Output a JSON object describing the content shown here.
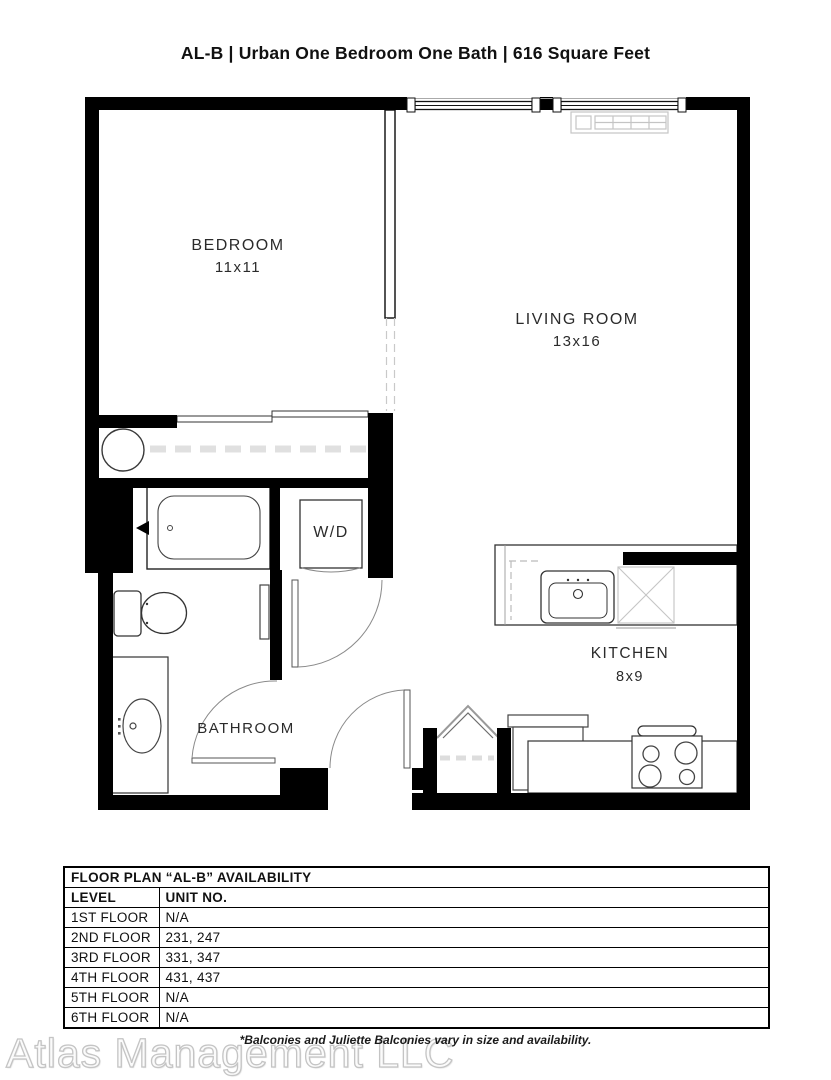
{
  "title": "AL-B | Urban One Bedroom One Bath | 616 Square Feet",
  "plan": {
    "rooms": {
      "bedroom": {
        "name": "BEDROOM",
        "dims": "11x11"
      },
      "living_room": {
        "name": "LIVING ROOM",
        "dims": "13x16"
      },
      "kitchen": {
        "name": "KITCHEN",
        "dims": "8x9"
      },
      "bathroom": {
        "name": "BATHROOM"
      },
      "washer_dryer": {
        "label": "W/D"
      }
    },
    "colors": {
      "wall": "#000000",
      "fixture_outline": "#3d3d3d",
      "light_detail": "#c9c9c9"
    }
  },
  "availability_table": {
    "title": "FLOOR PLAN “AL-B” AVAILABILITY",
    "columns": [
      "LEVEL",
      "UNIT NO."
    ],
    "rows": [
      {
        "level": "1ST FLOOR",
        "units": "N/A"
      },
      {
        "level": "2ND FLOOR",
        "units": "231, 247"
      },
      {
        "level": "3RD FLOOR",
        "units": "331, 347"
      },
      {
        "level": "4TH FLOOR",
        "units": "431, 437"
      },
      {
        "level": "5TH FLOOR",
        "units": "N/A"
      },
      {
        "level": "6TH FLOOR",
        "units": "N/A"
      }
    ]
  },
  "footer": {
    "note": "*Balconies and Juliette Balconies vary in size and availability.",
    "watermark": "Atlas Management LLC"
  }
}
